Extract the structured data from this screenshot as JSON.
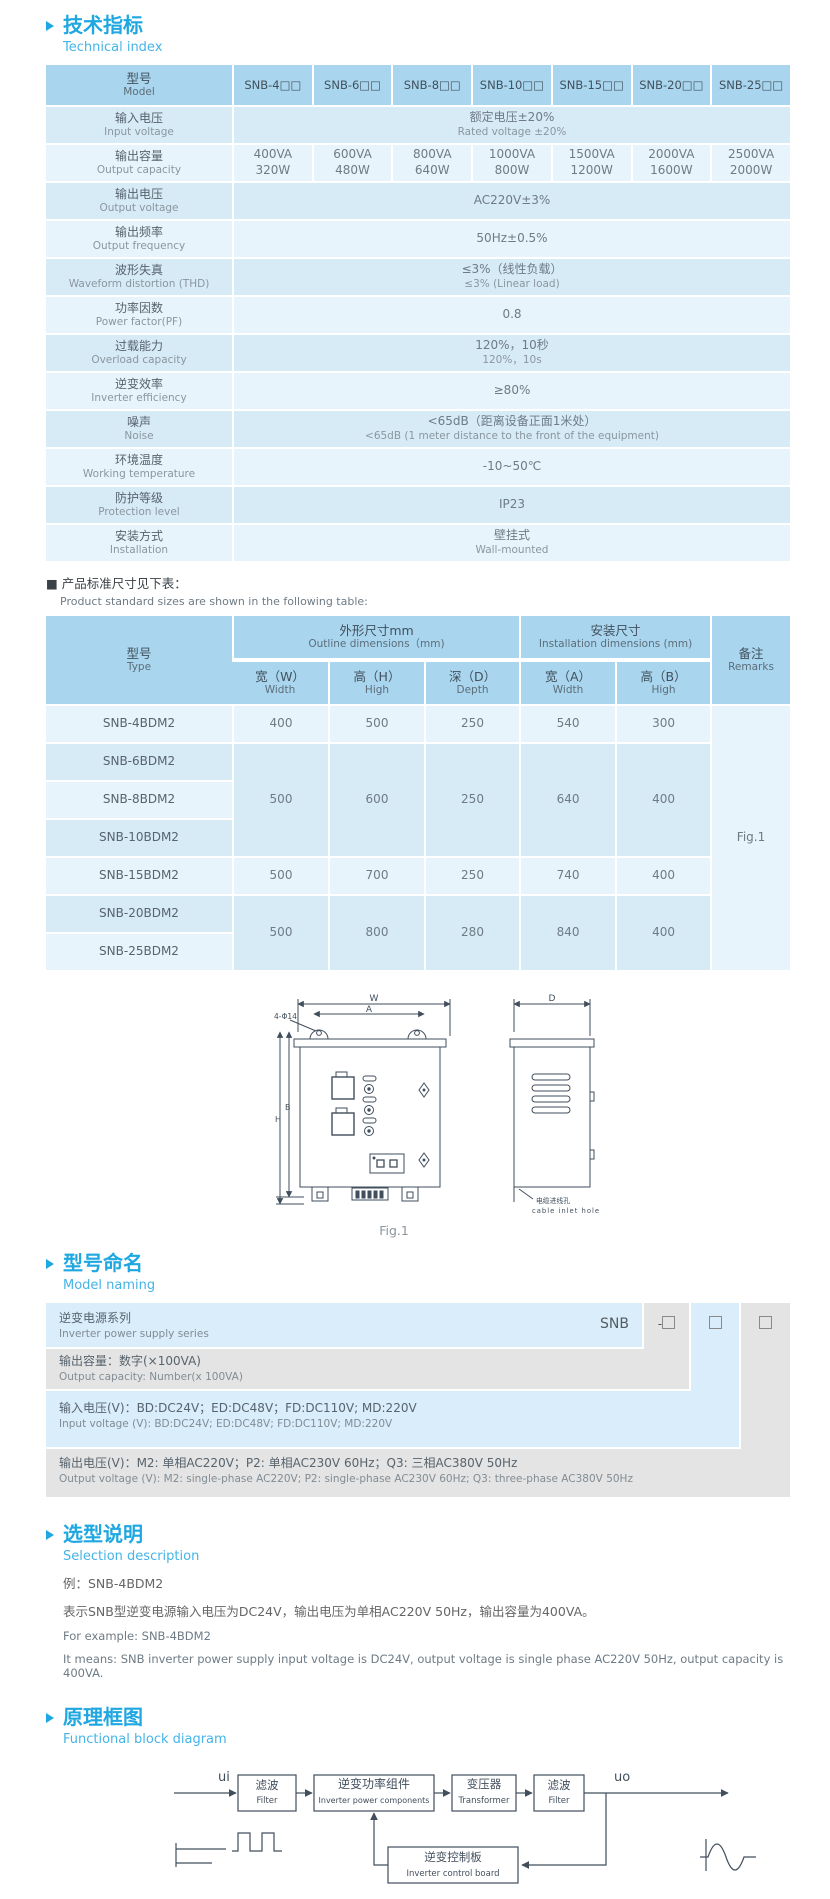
{
  "colors": {
    "accent": "#1ea7e0",
    "accent_light": "#45b4e8",
    "table_header": "#a9d6ee",
    "row_dark": "#d7ebf7",
    "row_light": "#e8f4fb",
    "band_blue": "#d9edfa",
    "band_gray": "#e4e4e4",
    "line": "#414e5c"
  },
  "tech_index": {
    "title_zh": "技术指标",
    "title_en": "Technical index"
  },
  "spec_table": {
    "model_label_zh": "型号",
    "model_label_en": "Model",
    "models": [
      "SNB-4□□",
      "SNB-6□□",
      "SNB-8□□",
      "SNB-10□□",
      "SNB-15□□",
      "SNB-20□□",
      "SNB-25□□"
    ],
    "rows": [
      {
        "zh": "输入电压",
        "en": "Input voltage",
        "val_zh": "额定电压±20%",
        "val_en": "Rated voltage ±20%"
      },
      {
        "zh": "输出容量",
        "en": "Output capacity",
        "cols": [
          [
            "400VA",
            "320W"
          ],
          [
            "600VA",
            "480W"
          ],
          [
            "800VA",
            "640W"
          ],
          [
            "1000VA",
            "800W"
          ],
          [
            "1500VA",
            "1200W"
          ],
          [
            "2000VA",
            "1600W"
          ],
          [
            "2500VA",
            "2000W"
          ]
        ]
      },
      {
        "zh": "输出电压",
        "en": "Output voltage",
        "val_zh": "AC220V±3%"
      },
      {
        "zh": "输出频率",
        "en": "Output frequency",
        "val_zh": "50Hz±0.5%"
      },
      {
        "zh": "波形失真",
        "en": "Waveform distortion (THD)",
        "val_zh": "≤3%（线性负载）",
        "val_en": "≤3% (Linear load)"
      },
      {
        "zh": "功率因数",
        "en": "Power factor(PF)",
        "val_zh": "0.8"
      },
      {
        "zh": "过载能力",
        "en": "Overload capacity",
        "val_zh": "120%，10秒",
        "val_en": "120%，10s"
      },
      {
        "zh": "逆变效率",
        "en": "Inverter efficiency",
        "val_zh": "≥80%"
      },
      {
        "zh": "噪声",
        "en": "Noise",
        "val_zh": "<65dB（距离设备正面1米处）",
        "val_en": "<65dB (1 meter distance to the front of the equipment)"
      },
      {
        "zh": "环境温度",
        "en": "Working temperature",
        "val_zh": "-10~50℃"
      },
      {
        "zh": "防护等级",
        "en": "Protection level",
        "val_zh": "IP23"
      },
      {
        "zh": "安装方式",
        "en": "Installation",
        "val_zh": "壁挂式",
        "val_en": "Wall-mounted"
      }
    ]
  },
  "size_note": {
    "zh": "■ 产品标准尺寸见下表：",
    "en": "Product standard sizes are shown in the following table:"
  },
  "dim_table": {
    "type_zh": "型号",
    "type_en": "Type",
    "outline_zh": "外形尺寸mm",
    "outline_en": "Outline dimensions（mm)",
    "install_zh": "安装尺寸",
    "install_en": "Installation dimensions (mm)",
    "remarks_zh": "备注",
    "remarks_en": "Remarks",
    "cols": [
      {
        "zh": "宽（W）",
        "en": "Width"
      },
      {
        "zh": "高（H）",
        "en": "High"
      },
      {
        "zh": "深（D）",
        "en": "Depth"
      },
      {
        "zh": "宽（A）",
        "en": "Width"
      },
      {
        "zh": "高（B）",
        "en": "High"
      }
    ],
    "rows": [
      {
        "type": "SNB-4BDM2",
        "vals": [
          "400",
          "500",
          "250",
          "540",
          "300"
        ],
        "rs": 1
      },
      {
        "type": "SNB-6BDM2",
        "vals": [
          "500",
          "600",
          "250",
          "640",
          "400"
        ],
        "rs": 3
      },
      {
        "type": "SNB-8BDM2"
      },
      {
        "type": "SNB-10BDM2"
      },
      {
        "type": "SNB-15BDM2",
        "vals": [
          "500",
          "700",
          "250",
          "740",
          "400"
        ],
        "rs": 1
      },
      {
        "type": "SNB-20BDM2",
        "vals": [
          "500",
          "800",
          "280",
          "840",
          "400"
        ],
        "rs": 2
      },
      {
        "type": "SNB-25BDM2"
      }
    ],
    "remarks_val": "Fig.1"
  },
  "figure": {
    "dim_w": "W",
    "dim_a": "A",
    "dim_d": "D",
    "dim_h": "H",
    "dim_b": "B",
    "holes": "4-Φ14",
    "cable_zh": "电缆进线孔",
    "cable_en": "cable inlet hole",
    "caption": "Fig.1"
  },
  "model_naming": {
    "title_zh": "型号命名",
    "title_en": "Model naming",
    "series_zh": "逆变电源系列",
    "series_en": "Inverter power supply series",
    "series_code": "SNB",
    "code_dash": "-",
    "row2_zh": "输出容量：数字(×100VA)",
    "row2_en": "Output capacity: Number(x 100VA)",
    "row3_zh": "输入电压(V)：BD:DC24V；ED:DC48V；FD:DC110V; MD:220V",
    "row3_en": "Input voltage (V): BD:DC24V; ED:DC48V; FD:DC110V; MD:220V",
    "row4_zh": "输出电压(V)：M2: 单相AC220V；P2: 单相AC230V 60Hz；Q3: 三相AC380V 50Hz",
    "row4_en": "Output voltage (V): M2: single-phase AC220V; P2: single-phase AC230V 60Hz; Q3: three-phase AC380V 50Hz"
  },
  "selection": {
    "title_zh": "选型说明",
    "title_en": "Selection description",
    "lines": [
      "例：SNB-4BDM2",
      "表示SNB型逆变电源输入电压为DC24V，输出电压为单相AC220V 50Hz，输出容量为400VA。",
      "For example: SNB-4BDM2",
      "It means: SNB inverter power supply input voltage is DC24V, output voltage is single phase AC220V 50Hz, output capacity is 400VA."
    ]
  },
  "block_diagram": {
    "title_zh": "原理框图",
    "title_en": "Functional block diagram",
    "input": "ui",
    "output": "uo",
    "filter1_zh": "滤波",
    "filter1_en": "Filter",
    "power_zh": "逆变功率组件",
    "power_en": "Inverter power components",
    "transformer_zh": "变压器",
    "transformer_en": "Transformer",
    "filter2_zh": "滤波",
    "filter2_en": "Filter",
    "control_zh": "逆变控制板",
    "control_en": "Inverter control board"
  }
}
